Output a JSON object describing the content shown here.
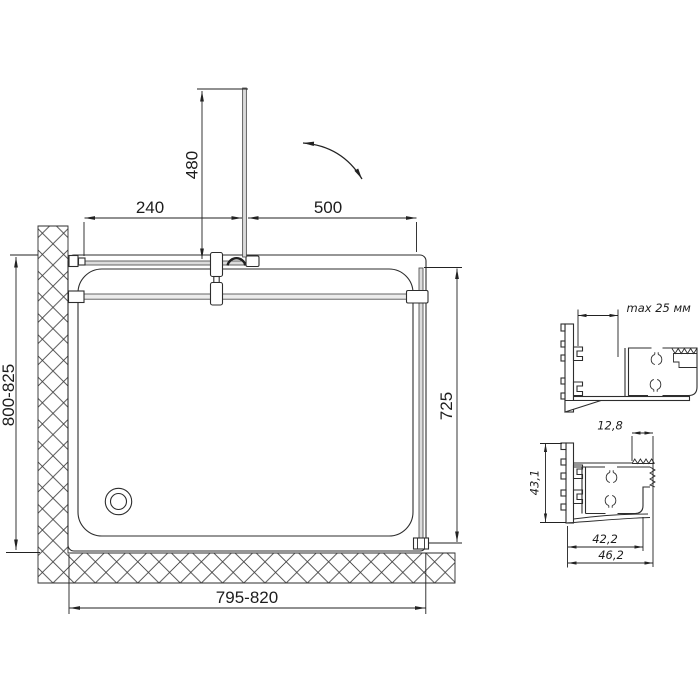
{
  "meta": {
    "type": "technical-installation-drawing",
    "subject": "shower enclosure with tray, plan view and profile sections",
    "ink_color": "#2d2d2d",
    "glass_fill_color": "#dcdcdc",
    "background": "#ffffff"
  },
  "plan": {
    "dims": {
      "door_open_depth": "480",
      "fixed_segment": "240",
      "door_width": "500",
      "depth_range": "800-825",
      "side_panel_length": "725",
      "width_range": "795-820"
    }
  },
  "details": {
    "upper": {
      "adjustment": "max 25 мм"
    },
    "lower": {
      "gasket_width": "12,8",
      "profile_height": "43,1",
      "width_inner": "42,2",
      "width_outer": "46,2"
    }
  }
}
